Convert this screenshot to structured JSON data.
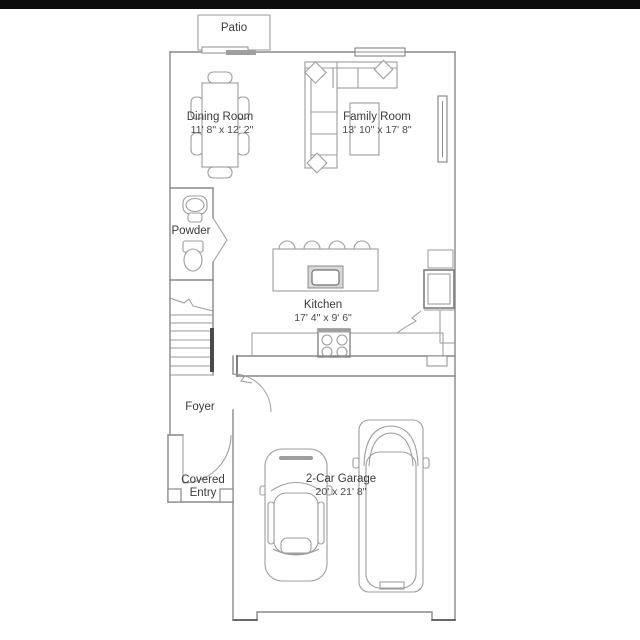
{
  "plan": {
    "type": "residential-floor-plan",
    "labels": {
      "patio": "Patio",
      "dining_name": "Dining Room",
      "dining_dims": "11' 8\" x 12' 2\"",
      "family_name": "Family Room",
      "family_dims": "13' 10\" x 17' 8\"",
      "powder": "Powder",
      "kitchen_name": "Kitchen",
      "kitchen_dims": "17' 4\" x 9' 6\"",
      "foyer": "Foyer",
      "entry_line1": "Covered",
      "entry_line2": "Entry",
      "garage_name": "2-Car Garage",
      "garage_dims": "20' x 21' 8\""
    },
    "colors": {
      "background": "#ffffff",
      "top_bar": "#0d0d0d",
      "wall_line": "#898989",
      "furniture_line": "#9d9d9d",
      "dark_accent": "#4a4a4a",
      "label_text": "#3a3a3a"
    }
  }
}
